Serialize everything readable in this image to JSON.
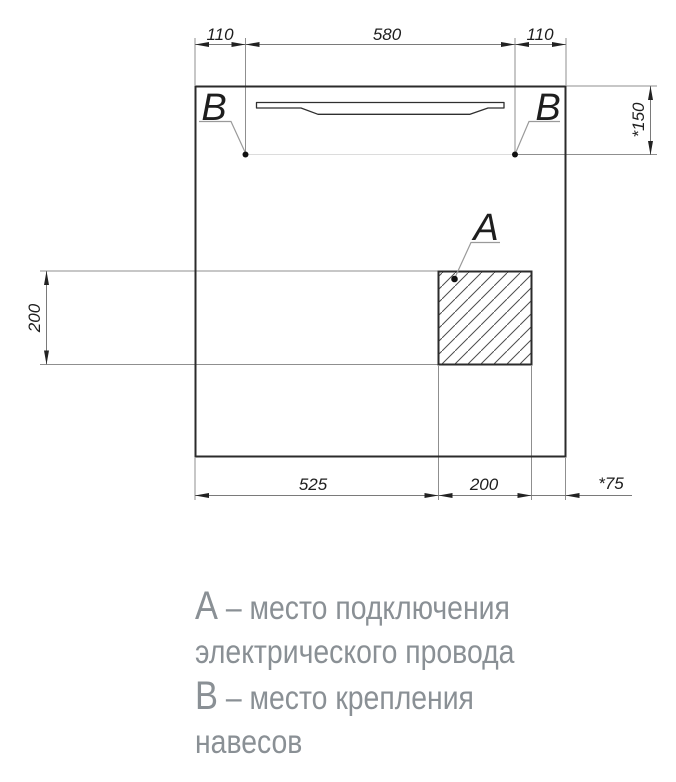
{
  "drawing": {
    "dims": {
      "top": [
        "110",
        "580",
        "110"
      ],
      "right": "*150",
      "left": "200",
      "bottom": [
        "525",
        "200",
        "*75"
      ]
    },
    "labels": {
      "a": "А",
      "b": "В"
    }
  },
  "legend": {
    "lines": [
      {
        "key": "А",
        "text": " – место подключения"
      },
      {
        "key": "",
        "text": "электрического провода"
      },
      {
        "key": "В",
        "text": " – место крепления"
      },
      {
        "key": "",
        "text": "навесов"
      }
    ]
  },
  "colors": {
    "outline": "#2b2b2b",
    "dimension_lines": "#7a7a7a",
    "extension_lines": "#8f8f8f",
    "legend_text": "#8a9095",
    "background": "#ffffff"
  }
}
